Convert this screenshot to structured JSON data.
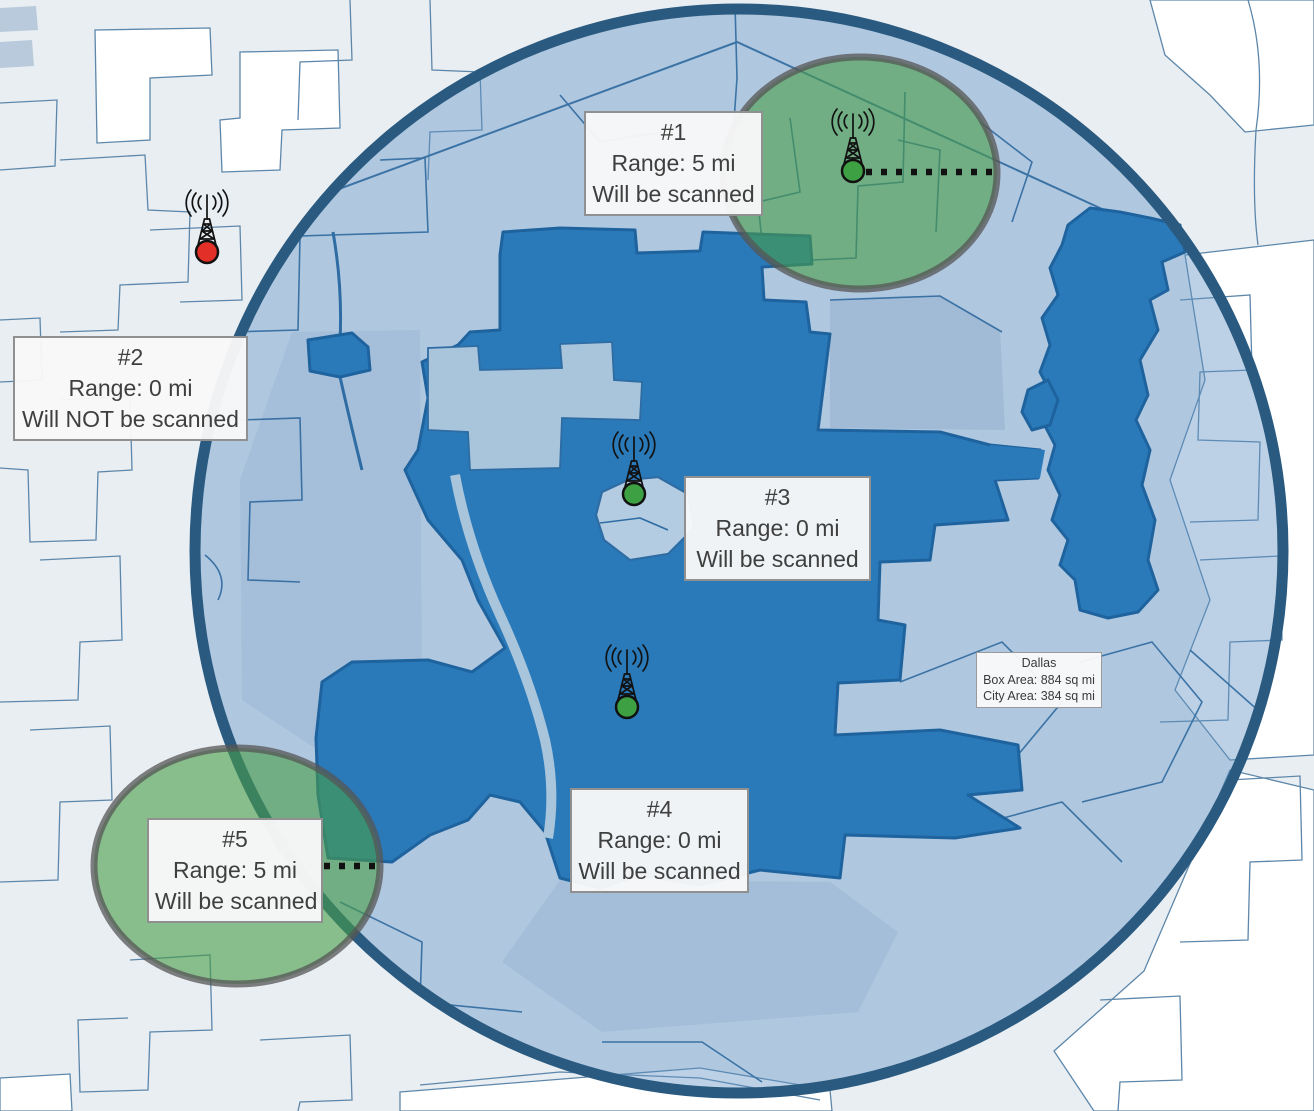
{
  "towers": [
    {
      "id": "#1",
      "range": "Range: 5 mi",
      "status": "Will be scanned",
      "marker_color": "#3da043"
    },
    {
      "id": "#2",
      "range": "Range: 0 mi",
      "status": "Will NOT be scanned",
      "marker_color": "#e22f28"
    },
    {
      "id": "#3",
      "range": "Range: 0 mi",
      "status": "Will be scanned",
      "marker_color": "#3da043"
    },
    {
      "id": "#4",
      "range": "Range: 0 mi",
      "status": "Will be scanned",
      "marker_color": "#3da043"
    },
    {
      "id": "#5",
      "range": "Range: 5 mi",
      "status": "Will be scanned",
      "marker_color": "#3da043"
    }
  ],
  "city_info": {
    "name": "Dallas",
    "box_area": "Box Area: 884 sq mi",
    "city_area": "City Area: 384 sq mi"
  },
  "colors": {
    "scan_circle_border": "#2a5a80",
    "scan_circle_fill": "rgba(95,145,195,0.42)",
    "range_circle_fill": "rgba(72,157,72,0.60)",
    "range_circle_border": "rgba(85,85,85,0.75)",
    "city_fill": "#2a7ab9",
    "background": "#e9eef3"
  }
}
